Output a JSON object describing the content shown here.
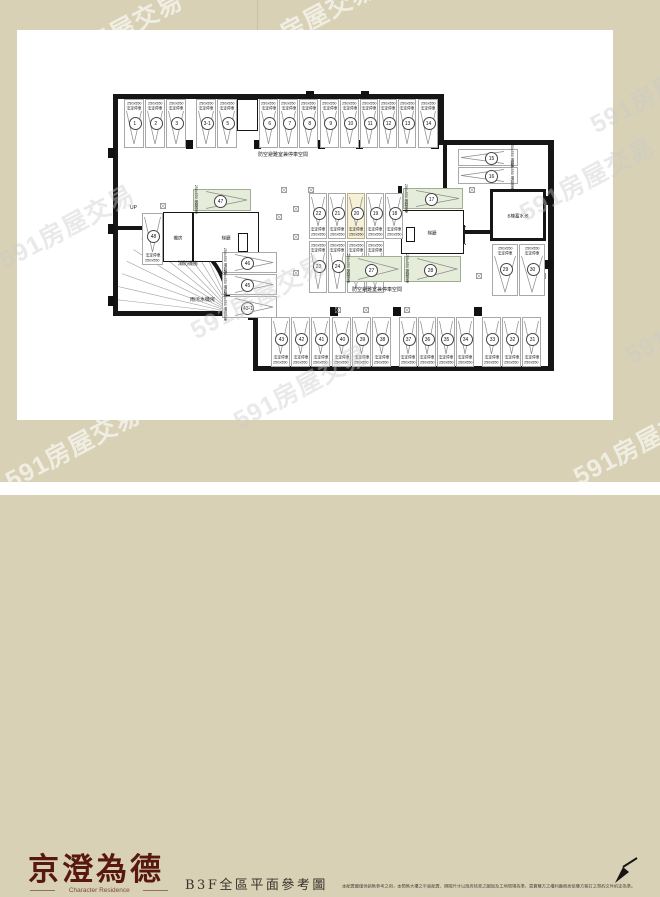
{
  "watermark": {
    "text": "591房屋交易",
    "positions": [
      [
        40,
        14,
        1
      ],
      [
        233,
        2,
        1
      ],
      [
        583,
        72,
        0
      ],
      [
        -8,
        208,
        0
      ],
      [
        512,
        160,
        0
      ],
      [
        183,
        278,
        0
      ],
      [
        226,
        368,
        0
      ],
      [
        566,
        424,
        1
      ],
      [
        618,
        303,
        0
      ],
      [
        -2,
        428,
        1
      ]
    ]
  },
  "footer": {
    "logo_main": "京澄為德",
    "logo_sub": "Character Residence",
    "caption": "B3F全區平面參考圖",
    "disclaimer": "本配置圖僅供銷售參考之用，本預售大樓之平面配置、隔間尺寸以政府核准之圖說及工地現場為準，買賣雙方之權利義務悉依雙方簽訂之契約文件約定為準。"
  },
  "plan": {
    "labels": {
      "size": "250x550",
      "t1": "法定停車",
      "t2": "獎勵停車",
      "t3": "增設停車",
      "shelter": "防空避難室兼停車空間",
      "up": "UP",
      "machine_room": "機房",
      "fire_room": "消防機房",
      "sewage_room": "雨污水機房",
      "water_tank": "B棟蓄水池",
      "lobby": "梯廳"
    },
    "stalls": [
      {
        "n": "1",
        "x": 124,
        "y": 99,
        "w": 20,
        "h": 49,
        "o": "v",
        "lp": "top",
        "t": "t1",
        "c": "w"
      },
      {
        "n": "2",
        "x": 145,
        "y": 99,
        "w": 20,
        "h": 49,
        "o": "v",
        "lp": "top",
        "t": "t1",
        "c": "w"
      },
      {
        "n": "3",
        "x": 166,
        "y": 99,
        "w": 20,
        "h": 49,
        "o": "v",
        "lp": "top",
        "t": "t1",
        "c": "w"
      },
      {
        "n": "3-1",
        "x": 196,
        "y": 99,
        "w": 20,
        "h": 49,
        "o": "v",
        "lp": "top",
        "t": "t1",
        "c": "w"
      },
      {
        "n": "5",
        "x": 217,
        "y": 99,
        "w": 20,
        "h": 49,
        "o": "v",
        "lp": "top",
        "t": "t1",
        "c": "w"
      },
      {
        "n": "6",
        "x": 259,
        "y": 99,
        "w": 19,
        "h": 49,
        "o": "v",
        "lp": "top",
        "t": "t1",
        "c": "w"
      },
      {
        "n": "7",
        "x": 279,
        "y": 99,
        "w": 19,
        "h": 49,
        "o": "v",
        "lp": "top",
        "t": "t1",
        "c": "w"
      },
      {
        "n": "8",
        "x": 299,
        "y": 99,
        "w": 19,
        "h": 49,
        "o": "v",
        "lp": "top",
        "t": "t1",
        "c": "w"
      },
      {
        "n": "9",
        "x": 320,
        "y": 99,
        "w": 19,
        "h": 49,
        "o": "v",
        "lp": "top",
        "t": "t1",
        "c": "w"
      },
      {
        "n": "10",
        "x": 340,
        "y": 99,
        "w": 19,
        "h": 49,
        "o": "v",
        "lp": "top",
        "t": "t1",
        "c": "w"
      },
      {
        "n": "11",
        "x": 360,
        "y": 99,
        "w": 18,
        "h": 49,
        "o": "v",
        "lp": "top",
        "t": "t1",
        "c": "w"
      },
      {
        "n": "12",
        "x": 379,
        "y": 99,
        "w": 18,
        "h": 49,
        "o": "v",
        "lp": "top",
        "t": "t1",
        "c": "w"
      },
      {
        "n": "13",
        "x": 398,
        "y": 99,
        "w": 18,
        "h": 49,
        "o": "v",
        "lp": "top",
        "t": "t1",
        "c": "w"
      },
      {
        "n": "14",
        "x": 418,
        "y": 99,
        "w": 20,
        "h": 49,
        "o": "v",
        "lp": "top",
        "t": "t1",
        "c": "w"
      },
      {
        "n": "15",
        "x": 458,
        "y": 149,
        "w": 60,
        "h": 17,
        "o": "h",
        "lp": "right",
        "t": "t3",
        "c": "w"
      },
      {
        "n": "16",
        "x": 458,
        "y": 167,
        "w": 60,
        "h": 17,
        "o": "h",
        "lp": "right",
        "t": "t3",
        "c": "w"
      },
      {
        "n": "17",
        "x": 403,
        "y": 188,
        "w": 60,
        "h": 21,
        "o": "h",
        "lp": "left",
        "t": "t2",
        "c": "g"
      },
      {
        "n": "18",
        "x": 385,
        "y": 193,
        "w": 18,
        "h": 46,
        "o": "v",
        "lp": "bottom",
        "t": "t1",
        "c": "w"
      },
      {
        "n": "19",
        "x": 366,
        "y": 193,
        "w": 18,
        "h": 46,
        "o": "v",
        "lp": "bottom",
        "t": "t1",
        "c": "w"
      },
      {
        "n": "20",
        "x": 347,
        "y": 193,
        "w": 18,
        "h": 46,
        "o": "v",
        "lp": "bottom",
        "t": "t1",
        "c": "y"
      },
      {
        "n": "21",
        "x": 328,
        "y": 193,
        "w": 18,
        "h": 46,
        "o": "v",
        "lp": "bottom",
        "t": "t1",
        "c": "w"
      },
      {
        "n": "22",
        "x": 309,
        "y": 193,
        "w": 18,
        "h": 46,
        "o": "v",
        "lp": "bottom",
        "t": "t1",
        "c": "w"
      },
      {
        "n": "23",
        "x": 309,
        "y": 241,
        "w": 18,
        "h": 52,
        "o": "v",
        "lp": "top",
        "t": "t1",
        "c": "w"
      },
      {
        "n": "24",
        "x": 328,
        "y": 241,
        "w": 18,
        "h": 52,
        "o": "v",
        "lp": "top",
        "t": "t1",
        "c": "w"
      },
      {
        "n": "25",
        "x": 347,
        "y": 241,
        "w": 18,
        "h": 52,
        "o": "v",
        "lp": "top",
        "t": "t1",
        "c": "w"
      },
      {
        "n": "26",
        "x": 366,
        "y": 241,
        "w": 18,
        "h": 52,
        "o": "v",
        "lp": "top",
        "t": "t1",
        "c": "w"
      },
      {
        "n": "27",
        "x": 345,
        "y": 256,
        "w": 57,
        "h": 26,
        "o": "h",
        "lp": "left",
        "t": "t2",
        "c": "g"
      },
      {
        "n": "28",
        "x": 404,
        "y": 256,
        "w": 57,
        "h": 26,
        "o": "h",
        "lp": "left",
        "t": "t2",
        "c": "g"
      },
      {
        "n": "29",
        "x": 492,
        "y": 244,
        "w": 26,
        "h": 52,
        "o": "v",
        "lp": "top",
        "t": "t1",
        "c": "w"
      },
      {
        "n": "30",
        "x": 519,
        "y": 244,
        "w": 26,
        "h": 52,
        "o": "v",
        "lp": "top",
        "t": "t1",
        "c": "w"
      },
      {
        "n": "47",
        "x": 193,
        "y": 189,
        "w": 58,
        "h": 22,
        "o": "h",
        "lp": "left",
        "t": "t2",
        "c": "g"
      },
      {
        "n": "48",
        "x": 142,
        "y": 213,
        "w": 21,
        "h": 52,
        "o": "v",
        "lp": "bottom",
        "t": "t1",
        "c": "w"
      },
      {
        "n": "46",
        "x": 222,
        "y": 252,
        "w": 55,
        "h": 21,
        "o": "h",
        "lp": "left",
        "t": "t3",
        "c": "w"
      },
      {
        "n": "45",
        "x": 222,
        "y": 274,
        "w": 55,
        "h": 21,
        "o": "h",
        "lp": "left",
        "t": "t3",
        "c": "w"
      },
      {
        "n": "43-1",
        "x": 222,
        "y": 296,
        "w": 55,
        "h": 22,
        "o": "h",
        "lp": "left",
        "t": "t3",
        "c": "w"
      },
      {
        "n": "43",
        "x": 271,
        "y": 317,
        "w": 19,
        "h": 50,
        "o": "v",
        "lp": "bottom",
        "t": "t1",
        "c": "w"
      },
      {
        "n": "42",
        "x": 291,
        "y": 317,
        "w": 19,
        "h": 50,
        "o": "v",
        "lp": "bottom",
        "t": "t1",
        "c": "w"
      },
      {
        "n": "41",
        "x": 311,
        "y": 317,
        "w": 19,
        "h": 50,
        "o": "v",
        "lp": "bottom",
        "t": "t1",
        "c": "w"
      },
      {
        "n": "40",
        "x": 332,
        "y": 317,
        "w": 19,
        "h": 50,
        "o": "v",
        "lp": "bottom",
        "t": "t1",
        "c": "w"
      },
      {
        "n": "39",
        "x": 352,
        "y": 317,
        "w": 19,
        "h": 50,
        "o": "v",
        "lp": "bottom",
        "t": "t1",
        "c": "w"
      },
      {
        "n": "38",
        "x": 372,
        "y": 317,
        "w": 19,
        "h": 50,
        "o": "v",
        "lp": "bottom",
        "t": "t1",
        "c": "w"
      },
      {
        "n": "37",
        "x": 399,
        "y": 317,
        "w": 18,
        "h": 50,
        "o": "v",
        "lp": "bottom",
        "t": "t1",
        "c": "w"
      },
      {
        "n": "36",
        "x": 418,
        "y": 317,
        "w": 18,
        "h": 50,
        "o": "v",
        "lp": "bottom",
        "t": "t1",
        "c": "w"
      },
      {
        "n": "35",
        "x": 437,
        "y": 317,
        "w": 18,
        "h": 50,
        "o": "v",
        "lp": "bottom",
        "t": "t1",
        "c": "w"
      },
      {
        "n": "34",
        "x": 456,
        "y": 317,
        "w": 18,
        "h": 50,
        "o": "v",
        "lp": "bottom",
        "t": "t1",
        "c": "w"
      },
      {
        "n": "33",
        "x": 482,
        "y": 317,
        "w": 19,
        "h": 50,
        "o": "v",
        "lp": "bottom",
        "t": "t1",
        "c": "w"
      },
      {
        "n": "32",
        "x": 502,
        "y": 317,
        "w": 19,
        "h": 50,
        "o": "v",
        "lp": "bottom",
        "t": "t1",
        "c": "w"
      },
      {
        "n": "31",
        "x": 522,
        "y": 317,
        "w": 19,
        "h": 50,
        "o": "v",
        "lp": "bottom",
        "t": "t1",
        "c": "w"
      }
    ],
    "walls": [
      [
        113,
        94,
        330,
        5
      ],
      [
        438,
        94,
        6,
        51
      ],
      [
        438,
        140,
        116,
        5
      ],
      [
        548,
        140,
        6,
        231
      ],
      [
        253,
        366,
        301,
        5
      ],
      [
        253,
        313,
        5,
        56
      ],
      [
        113,
        94,
        5,
        222
      ],
      [
        113,
        311,
        145,
        5
      ],
      [
        443,
        145,
        4,
        48
      ],
      [
        398,
        186,
        4,
        26
      ],
      [
        464,
        230,
        28,
        4
      ],
      [
        113,
        226,
        40,
        4
      ]
    ],
    "pillars": [
      [
        186,
        140,
        7,
        9
      ],
      [
        254,
        140,
        7,
        9
      ],
      [
        318,
        140,
        7,
        9
      ],
      [
        356,
        140,
        7,
        9
      ],
      [
        431,
        140,
        8,
        9
      ],
      [
        330,
        307,
        8,
        9
      ],
      [
        393,
        307,
        8,
        9
      ],
      [
        474,
        307,
        8,
        9
      ],
      [
        108,
        148,
        7,
        10
      ],
      [
        108,
        224,
        7,
        10
      ],
      [
        108,
        296,
        7,
        10
      ],
      [
        545,
        196,
        8,
        9
      ],
      [
        545,
        260,
        8,
        9
      ],
      [
        248,
        311,
        8,
        9
      ],
      [
        306,
        91,
        8,
        7
      ],
      [
        361,
        91,
        8,
        7
      ]
    ],
    "col_marks": [
      [
        281,
        180
      ],
      [
        308,
        180
      ],
      [
        293,
        199
      ],
      [
        293,
        227
      ],
      [
        293,
        263
      ],
      [
        335,
        300
      ],
      [
        363,
        300
      ],
      [
        404,
        300
      ],
      [
        469,
        153
      ],
      [
        469,
        180
      ],
      [
        476,
        266
      ],
      [
        540,
        266
      ],
      [
        222,
        207
      ],
      [
        248,
        207
      ],
      [
        276,
        207
      ],
      [
        160,
        196
      ]
    ],
    "elevators": [
      [
        240,
        103,
        15,
        15
      ],
      [
        196,
        233,
        18,
        19
      ],
      [
        217,
        233,
        18,
        19
      ],
      [
        427,
        225,
        18,
        19
      ],
      [
        447,
        225,
        18,
        19
      ]
    ],
    "rooms": [
      {
        "x": 237,
        "y": 99,
        "w": 21,
        "h": 32,
        "label": "",
        "thick": false
      },
      {
        "x": 490,
        "y": 189,
        "w": 56,
        "h": 52,
        "label": "water_tank",
        "thick": true
      },
      {
        "x": 163,
        "y": 212,
        "w": 30,
        "h": 50,
        "label": "machine_room",
        "thick": false
      },
      {
        "x": 193,
        "y": 212,
        "w": 66,
        "h": 50,
        "label": "lobby",
        "thick": false
      },
      {
        "x": 401,
        "y": 210,
        "w": 63,
        "h": 44,
        "label": "lobby",
        "thick": false
      },
      {
        "x": 238,
        "y": 233,
        "w": 10,
        "h": 19,
        "label": "",
        "thick": false
      },
      {
        "x": 406,
        "y": 227,
        "w": 9,
        "h": 15,
        "label": "",
        "thick": false
      }
    ],
    "texts": [
      {
        "k": "shelter",
        "x": 258,
        "y": 149
      },
      {
        "k": "shelter",
        "x": 352,
        "y": 284
      },
      {
        "k": "up",
        "x": 130,
        "y": 200
      },
      {
        "k": "fire_room",
        "x": 178,
        "y": 258
      },
      {
        "k": "sewage_room",
        "x": 190,
        "y": 294
      }
    ]
  },
  "colors": {
    "background_beige": "#d8d1b6",
    "page_white": "#ffffff",
    "stall_green": "#e5edda",
    "stall_cream": "#f6f0d6",
    "logo_red": "#58180f",
    "caption_brown": "#3a322b",
    "wall_black": "#161616"
  }
}
